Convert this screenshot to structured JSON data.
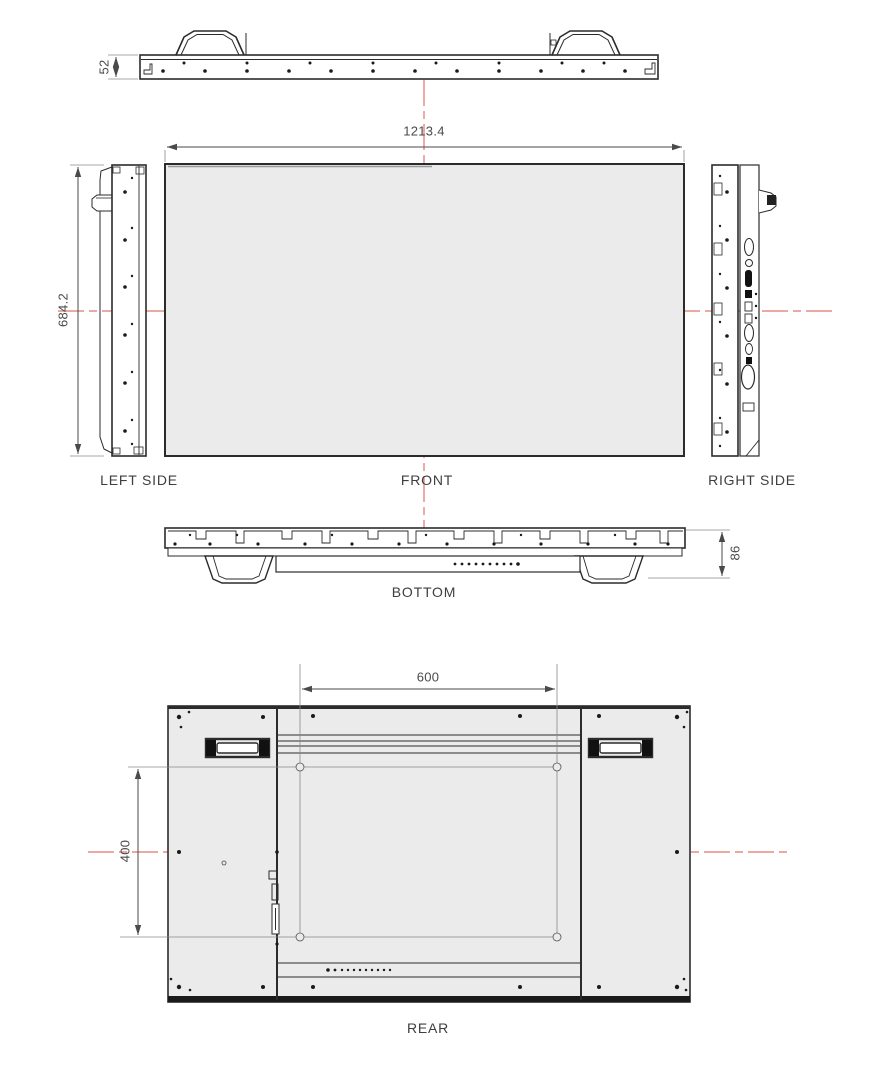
{
  "drawing": {
    "type": "technical-orthographic-views",
    "views": {
      "top": {
        "dim_height": "52"
      },
      "front": {
        "label": "FRONT",
        "dim_width": "1213.4",
        "dim_height": "684.2"
      },
      "left_side": {
        "label": "LEFT SIDE"
      },
      "right_side": {
        "label": "RIGHT SIDE"
      },
      "bottom": {
        "label": "BOTTOM",
        "dim_depth": "86"
      },
      "rear": {
        "label": "REAR",
        "dim_mount_width": "600",
        "dim_mount_height": "400"
      }
    },
    "colors": {
      "centerline_red": "#e2736c",
      "panel_fill": "#ebebeb",
      "line": "#2b2b2b",
      "dimension_gray": "#4a4a4a"
    }
  }
}
